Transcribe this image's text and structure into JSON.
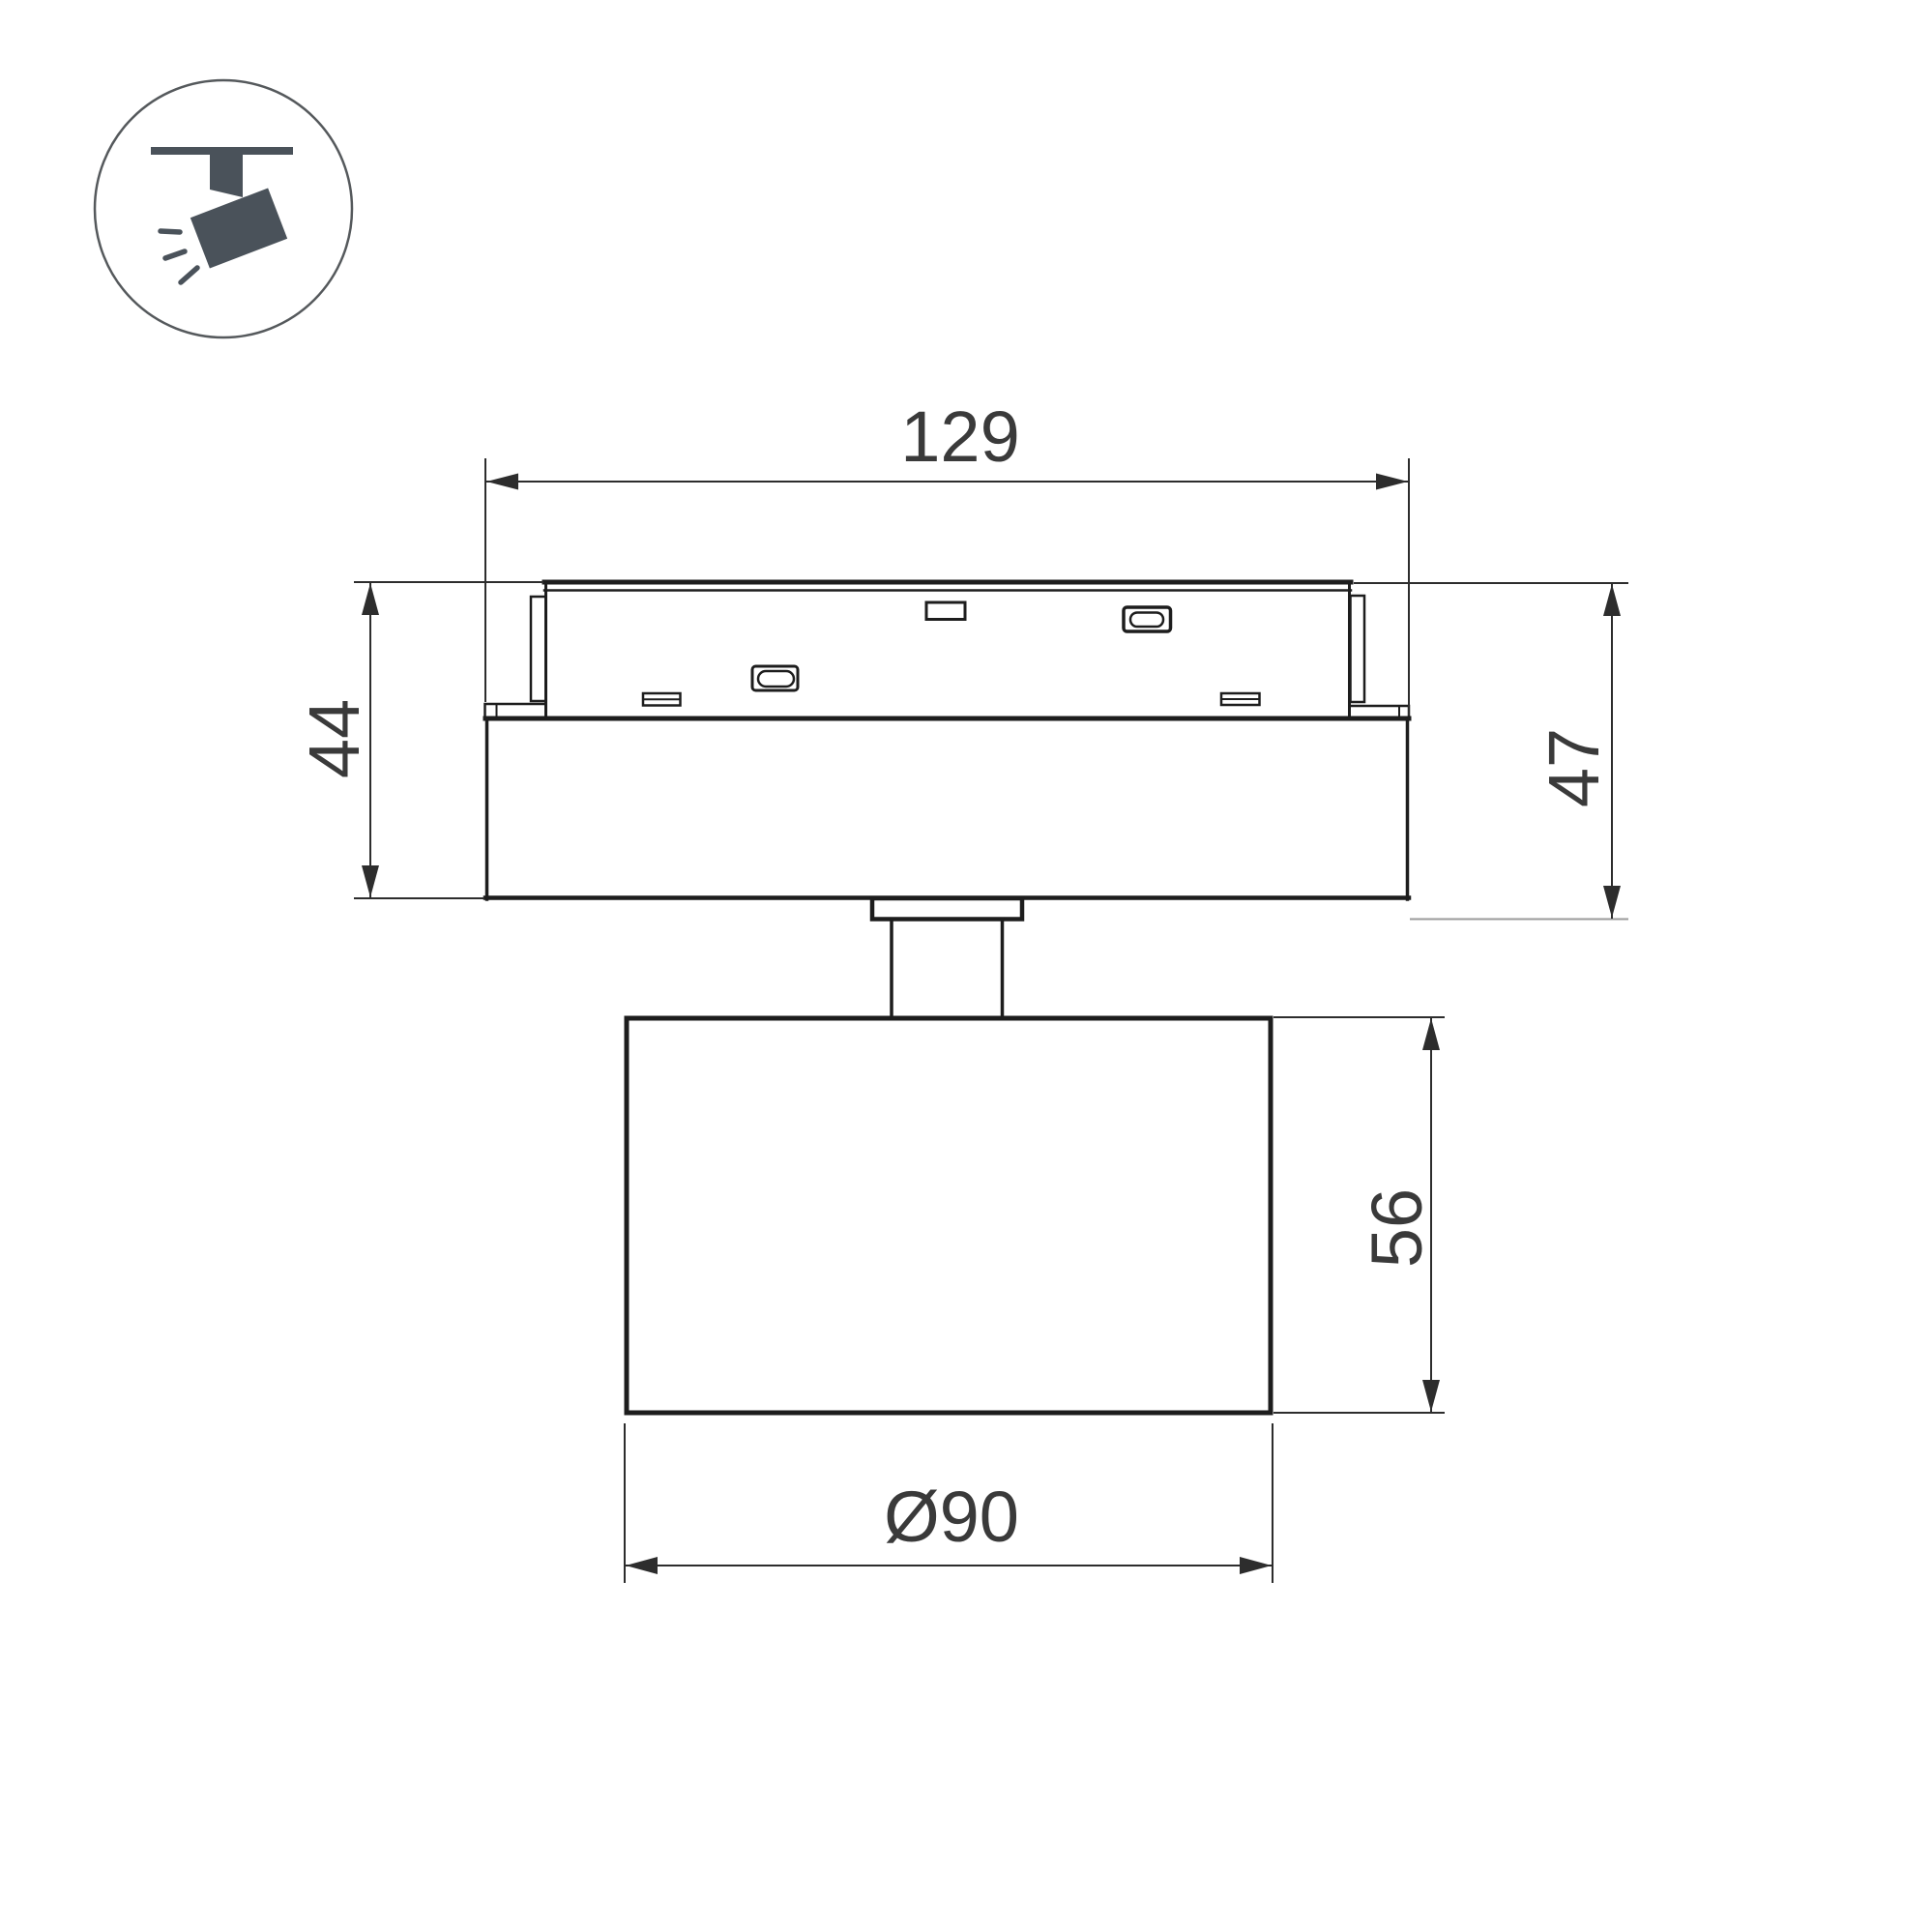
{
  "page": {
    "type": "product-dimension-drawing",
    "background": "#ffffff"
  },
  "icon_legend": {
    "name": "ceiling-track-spotlight",
    "fill_color": "#4a525a",
    "ring_color": "#55595c"
  },
  "drawing": {
    "line_color": "#1d1d1d",
    "dimension_line_color": "#2d2d2d",
    "dimension_text_color": "#3a3a3a",
    "light_extension_color": "#9a9a9a",
    "dimensions": {
      "track_width": "129",
      "adapter_height": "44",
      "overall_height": "47",
      "head_height": "56",
      "head_diameter": "Ø90"
    }
  }
}
